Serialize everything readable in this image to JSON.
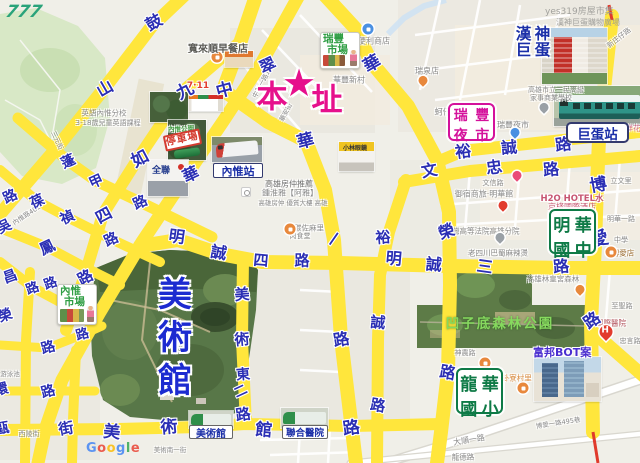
{
  "watermarks": {
    "handwritten": "777",
    "top_right_1": "yes319房屋市集",
    "top_right_2": "漢神巨蛋購物廣場",
    "google": [
      "G",
      "o",
      "o",
      "g",
      "l",
      "e"
    ],
    "google_colors": [
      "#4285F4",
      "#EA4335",
      "#FBBC05",
      "#4285F4",
      "#34A853",
      "#EA4335"
    ]
  },
  "main_site": {
    "left": "本",
    "star": "★",
    "right": "址",
    "color": "#e6108c"
  },
  "museum_vertical": [
    "美",
    "術",
    "館"
  ],
  "park_label": "凹子底森林公園",
  "station_labels": {
    "neiwei": "內惟站",
    "dome": "巨蛋站",
    "museum_stop": "美術館",
    "hospital_stop": "聯合醫院"
  },
  "school_labels": {
    "minghua": [
      "明",
      "華",
      "國",
      "中"
    ],
    "longhua": [
      "龍",
      "華",
      "國",
      "小"
    ]
  },
  "night_market": [
    "瑞",
    "豐",
    "夜",
    "市"
  ],
  "hanshin": [
    "漢",
    "神",
    "巨",
    "蛋"
  ],
  "market_cards": {
    "ruifeng": [
      "瑞豐",
      "市場"
    ],
    "neiwei": [
      "內惟",
      "市場"
    ]
  },
  "fubon_label": "富邦BOT案",
  "breakfast_label": "寬來順早餐店",
  "photo_captions": {
    "seven": "7·11",
    "parking": "停車場",
    "pxmart": "全聯",
    "glasses": "小林眼鏡",
    "neiwei_park": "內惟公園"
  },
  "accent_colors": {
    "road_yellow": "#ffe63c",
    "char_blue": "#2b2fb4",
    "magenta": "#e6108c",
    "label_green": "#0e7a46"
  },
  "road_chars": [
    {
      "c": "鼓",
      "x": 153,
      "y": 21,
      "r": -30,
      "s": 16
    },
    {
      "c": "山",
      "x": 104,
      "y": 87,
      "r": -30,
      "s": 16
    },
    {
      "c": "翠",
      "x": 267,
      "y": 64,
      "r": -25,
      "s": 16
    },
    {
      "c": "華",
      "x": 190,
      "y": 173,
      "r": -25,
      "s": 16
    },
    {
      "c": "九",
      "x": 184,
      "y": 89,
      "r": -28,
      "s": 17
    },
    {
      "c": "如",
      "x": 139,
      "y": 157,
      "r": -28,
      "s": 17
    },
    {
      "c": "四",
      "x": 103,
      "y": 214,
      "r": -28,
      "s": 16
    },
    {
      "c": "路",
      "x": 85,
      "y": 277,
      "r": -28,
      "s": 15
    },
    {
      "c": "中",
      "x": 224,
      "y": 88,
      "r": -15,
      "s": 17
    },
    {
      "c": "華",
      "x": 305,
      "y": 139,
      "r": -15,
      "s": 17
    },
    {
      "c": "一",
      "x": 334,
      "y": 239,
      "r": -55,
      "s": 15
    },
    {
      "c": "路",
      "x": 341,
      "y": 338,
      "r": -10,
      "s": 16
    },
    {
      "c": "蓬",
      "x": 68,
      "y": 161,
      "r": -25,
      "s": 14
    },
    {
      "c": "甲",
      "x": 96,
      "y": 181,
      "r": -25,
      "s": 14
    },
    {
      "c": "路",
      "x": 140,
      "y": 202,
      "r": -25,
      "s": 14
    },
    {
      "c": "葆",
      "x": 37,
      "y": 201,
      "r": -25,
      "s": 14
    },
    {
      "c": "禎",
      "x": 67,
      "y": 217,
      "r": -25,
      "s": 14
    },
    {
      "c": "路",
      "x": 111,
      "y": 239,
      "r": -25,
      "s": 14
    },
    {
      "c": "路",
      "x": 10,
      "y": 196,
      "r": -25,
      "s": 14
    },
    {
      "c": "吳",
      "x": 4,
      "y": 226,
      "r": -25,
      "s": 14
    },
    {
      "c": "鳳",
      "x": 47,
      "y": 247,
      "r": -25,
      "s": 15
    },
    {
      "c": "昌",
      "x": 10,
      "y": 276,
      "r": -20,
      "s": 14
    },
    {
      "c": "路",
      "x": 32,
      "y": 287,
      "r": -20,
      "s": 13
    },
    {
      "c": "路",
      "x": 50,
      "y": 282,
      "r": -20,
      "s": 13
    },
    {
      "c": "榮",
      "x": 5,
      "y": 315,
      "r": -20,
      "s": 14
    },
    {
      "c": "路",
      "x": 48,
      "y": 347,
      "r": -15,
      "s": 14
    },
    {
      "c": "路",
      "x": 82,
      "y": 333,
      "r": -15,
      "s": 13
    },
    {
      "c": "路",
      "x": 48,
      "y": 391,
      "r": -15,
      "s": 14
    },
    {
      "c": "街",
      "x": 66,
      "y": 428,
      "r": -10,
      "s": 15
    },
    {
      "c": "環",
      "x": 1,
      "y": 389,
      "r": -15,
      "s": 14
    },
    {
      "c": "甌",
      "x": 2,
      "y": 428,
      "r": -10,
      "s": 14
    },
    {
      "c": "美",
      "x": 112,
      "y": 430,
      "r": 5,
      "s": 17
    },
    {
      "c": "術",
      "x": 169,
      "y": 425,
      "r": -5,
      "s": 17
    },
    {
      "c": "館",
      "x": 264,
      "y": 428,
      "r": 5,
      "s": 17
    },
    {
      "c": "路",
      "x": 351,
      "y": 426,
      "r": -8,
      "s": 17
    },
    {
      "c": "美",
      "x": 242,
      "y": 294,
      "r": -5,
      "s": 15
    },
    {
      "c": "術",
      "x": 242,
      "y": 339,
      "r": -5,
      "s": 15
    },
    {
      "c": "東",
      "x": 243,
      "y": 374,
      "r": -5,
      "s": 14
    },
    {
      "c": "二",
      "x": 240,
      "y": 390,
      "r": -25,
      "s": 13
    },
    {
      "c": "路",
      "x": 243,
      "y": 414,
      "r": -8,
      "s": 15
    },
    {
      "c": "明",
      "x": 177,
      "y": 235,
      "r": 8,
      "s": 16
    },
    {
      "c": "誠",
      "x": 219,
      "y": 251,
      "r": 10,
      "s": 16
    },
    {
      "c": "四",
      "x": 261,
      "y": 260,
      "r": 5,
      "s": 15
    },
    {
      "c": "路",
      "x": 302,
      "y": 260,
      "r": 0,
      "s": 15
    },
    {
      "c": "明",
      "x": 394,
      "y": 257,
      "r": 5,
      "s": 16
    },
    {
      "c": "誠",
      "x": 434,
      "y": 263,
      "r": 5,
      "s": 16
    },
    {
      "c": "三",
      "x": 485,
      "y": 265,
      "r": 8,
      "s": 16
    },
    {
      "c": "路",
      "x": 561,
      "y": 265,
      "r": -5,
      "s": 16
    },
    {
      "c": "裕",
      "x": 463,
      "y": 150,
      "r": -8,
      "s": 16
    },
    {
      "c": "誠",
      "x": 509,
      "y": 146,
      "r": -5,
      "s": 16
    },
    {
      "c": "路",
      "x": 563,
      "y": 143,
      "r": -8,
      "s": 16
    },
    {
      "c": "文",
      "x": 429,
      "y": 169,
      "r": -10,
      "s": 16
    },
    {
      "c": "忠",
      "x": 494,
      "y": 166,
      "r": -8,
      "s": 16
    },
    {
      "c": "路",
      "x": 551,
      "y": 168,
      "r": -5,
      "s": 16
    },
    {
      "c": "裕",
      "x": 383,
      "y": 237,
      "r": -5,
      "s": 15
    },
    {
      "c": "誠",
      "x": 378,
      "y": 322,
      "r": 5,
      "s": 15
    },
    {
      "c": "路",
      "x": 378,
      "y": 405,
      "r": 10,
      "s": 15
    },
    {
      "c": "華",
      "x": 371,
      "y": 62,
      "r": -30,
      "s": 17
    },
    {
      "c": "榮",
      "x": 446,
      "y": 230,
      "r": -20,
      "s": 16
    },
    {
      "c": "路",
      "x": 448,
      "y": 371,
      "r": 10,
      "s": 16
    },
    {
      "c": "博",
      "x": 598,
      "y": 183,
      "r": -10,
      "s": 17
    },
    {
      "c": "愛",
      "x": 599,
      "y": 238,
      "r": -15,
      "s": 18
    },
    {
      "c": "路",
      "x": 591,
      "y": 319,
      "r": -35,
      "s": 16
    }
  ],
  "poi_texts": [
    {
      "t": "便利商店",
      "x": 374,
      "y": 41
    },
    {
      "t": "瑞泉店",
      "x": 427,
      "y": 71
    },
    {
      "t": "蚵仔煎·山東門店",
      "x": 464,
      "y": 112
    },
    {
      "t": "瑞豐夜市",
      "x": 513,
      "y": 125
    },
    {
      "t": "華豐新村",
      "x": 349,
      "y": 80
    },
    {
      "t": "中華一路15巷",
      "x": 263,
      "y": 79,
      "r": -62,
      "s": 6.5
    },
    {
      "t": "新庄仔路",
      "x": 619,
      "y": 38,
      "r": -38,
      "s": 7
    },
    {
      "t": "高雄市立三民高級",
      "x": 556,
      "y": 90,
      "s": 7
    },
    {
      "t": "家事商業學校",
      "x": 551,
      "y": 98,
      "s": 7
    },
    {
      "t": "英語內惟分校",
      "x": 104,
      "y": 113,
      "s": 7.5
    },
    {
      "t": "3-18歲兒童英語課程",
      "x": 108,
      "y": 123,
      "s": 7
    },
    {
      "t": "內惟路401",
      "x": 26,
      "y": 214,
      "r": -33,
      "s": 6.5
    },
    {
      "t": "三元街",
      "x": 58,
      "y": 140,
      "r": 65,
      "s": 6.5
    },
    {
      "t": "西陵街",
      "x": 29,
      "y": 434,
      "s": 7
    },
    {
      "t": "游泳池",
      "x": 10,
      "y": 373,
      "s": 6.5
    },
    {
      "t": "7·11",
      "x": 198,
      "y": 86,
      "c": "#e23c2e",
      "s": 9,
      "w": 700
    },
    {
      "t": "高雄房仲推薦",
      "x": 289,
      "y": 184,
      "c": "#6f6f6f"
    },
    {
      "t": "鍾淮雅【阿雅】",
      "x": 290,
      "y": 193
    },
    {
      "t": "高雄房仲 優質大樓 高雄",
      "x": 293,
      "y": 202,
      "s": 6.5
    },
    {
      "t": "碳佐麻里",
      "x": 309,
      "y": 228,
      "s": 7.5
    },
    {
      "t": "肉食堂",
      "x": 300,
      "y": 236,
      "s": 7
    },
    {
      "t": "文信路",
      "x": 493,
      "y": 183,
      "s": 7
    },
    {
      "t": "御宿商旅·明華館",
      "x": 484,
      "y": 194
    },
    {
      "t": "H2O HOTEL水",
      "x": 572,
      "y": 198,
      "c": "#c75672",
      "s": 8.5,
      "w": 700
    },
    {
      "t": "京棧國際酒店",
      "x": 572,
      "y": 207,
      "c": "#c75672"
    },
    {
      "t": "立文里",
      "x": 621,
      "y": 181,
      "s": 7
    },
    {
      "t": "明華一路",
      "x": 621,
      "y": 219,
      "s": 7
    },
    {
      "t": "中學",
      "x": 621,
      "y": 240,
      "s": 7
    },
    {
      "t": "博愛店",
      "x": 623,
      "y": 253,
      "s": 7.5,
      "c": "#9a6b2f"
    },
    {
      "t": "臺灣高等法院高雄分院",
      "x": 482,
      "y": 231,
      "s": 7.5
    },
    {
      "t": "老四川巴蜀麻辣燙",
      "x": 498,
      "y": 253,
      "s": 7.5
    },
    {
      "t": "高雄林皇宮森林",
      "x": 553,
      "y": 279,
      "s": 7.5
    },
    {
      "t": "至聖路",
      "x": 622,
      "y": 306,
      "s": 7
    },
    {
      "t": "國際醫院",
      "x": 611,
      "y": 323,
      "s": 7.5,
      "c": "#b3555f"
    },
    {
      "t": "忠言路",
      "x": 630,
      "y": 341,
      "s": 7
    },
    {
      "t": "神農路",
      "x": 465,
      "y": 353,
      "s": 7
    },
    {
      "t": "八卦寮村里",
      "x": 513,
      "y": 378,
      "s": 7.5,
      "c": "#d98a3d"
    },
    {
      "t": "大順一路",
      "x": 469,
      "y": 440,
      "r": -9,
      "s": 8
    },
    {
      "t": "博愛一路495巷",
      "x": 558,
      "y": 422,
      "r": -9,
      "s": 6.5
    },
    {
      "t": "龍德路",
      "x": 463,
      "y": 457,
      "s": 7.5
    },
    {
      "t": "美術南一街",
      "x": 170,
      "y": 449,
      "s": 6.5
    },
    {
      "t": "鮮花",
      "x": 633,
      "y": 128,
      "s": 7.5,
      "c": "#d46a8a"
    },
    {
      "t": "華安街",
      "x": 285,
      "y": 112,
      "r": -62,
      "s": 6.5
    },
    {
      "t": "內惟公園",
      "x": 181,
      "y": 128,
      "s": 6.5,
      "c": "#3f9b3f",
      "w": 700
    }
  ],
  "pins": [
    {
      "x": 368,
      "y": 29,
      "c": "#4a90e2",
      "k": "circle"
    },
    {
      "x": 423,
      "y": 84,
      "c": "#e8883c",
      "k": "drop"
    },
    {
      "x": 544,
      "y": 111,
      "c": "#9aa0a6",
      "k": "drop"
    },
    {
      "x": 515,
      "y": 136,
      "c": "#4a90e2",
      "k": "drop"
    },
    {
      "x": 517,
      "y": 179,
      "c": "#ea4b78",
      "k": "drop"
    },
    {
      "x": 503,
      "y": 209,
      "c": "#e23c2e",
      "k": "drop"
    },
    {
      "x": 500,
      "y": 241,
      "c": "#9aa0a6",
      "k": "drop"
    },
    {
      "x": 580,
      "y": 293,
      "c": "#e8883c",
      "k": "drop"
    },
    {
      "x": 485,
      "y": 363,
      "c": "#e8883c",
      "k": "circle"
    },
    {
      "x": 523,
      "y": 388,
      "c": "#e8883c",
      "k": "circle"
    },
    {
      "x": 217,
      "y": 57,
      "c": "#e8883c",
      "k": "circle"
    },
    {
      "x": 290,
      "y": 229,
      "c": "#e8883c",
      "k": "circle"
    },
    {
      "x": 611,
      "y": 252,
      "c": "#e8883c",
      "k": "circle"
    },
    {
      "x": 246,
      "y": 192,
      "c": "#ffffff",
      "k": "ad"
    },
    {
      "x": 606,
      "y": 337,
      "c": "#e23c2e",
      "k": "h"
    }
  ]
}
